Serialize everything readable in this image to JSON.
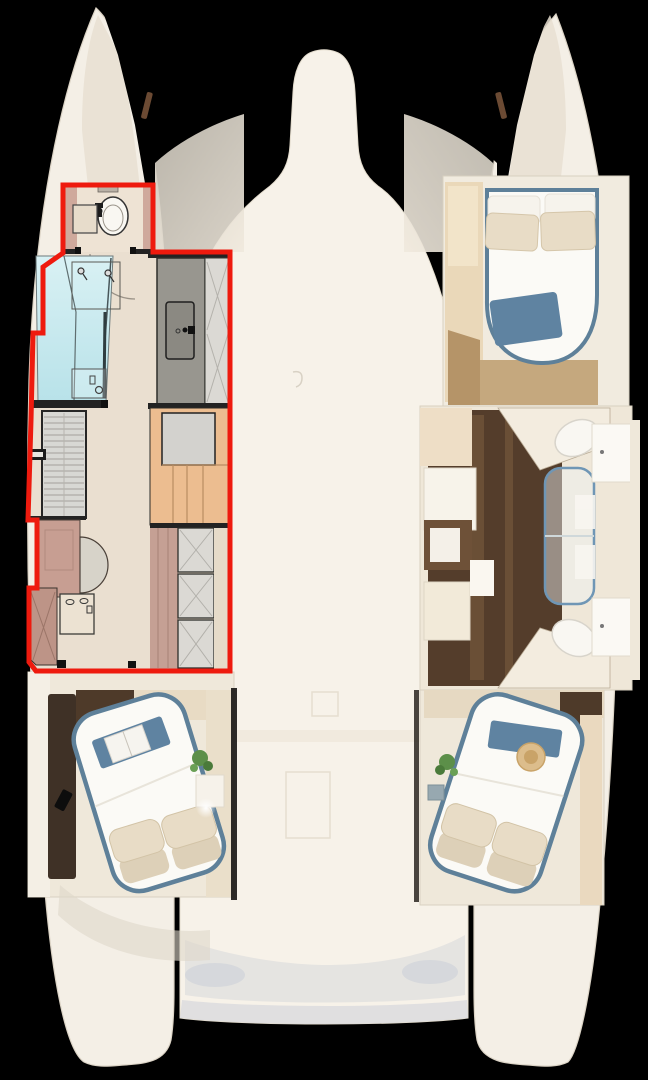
{
  "scene": {
    "kind": "catamaran-deck-floorplan-top-view",
    "background": "#000000"
  },
  "highlight": {
    "points": "63,185 153,185 153,252 230,252 230,671 36,671 29,662 29,588 37,588 37,520 28,520 31,420 33,333 43,333 43,267 63,253",
    "color": "#ee1a0e",
    "stroke_width": "5"
  },
  "colors": {
    "background": "#000000",
    "hull": "#f4efe6",
    "deck": "#f7f2e9",
    "bow_shadow": "#e7dfd1",
    "wing_shadow": "#cfc9bd",
    "plan_floor": "#eadfd0",
    "room_floor": "#eee3d4",
    "wall_pink": "#cfa99c",
    "wall_dark": "#232323",
    "shower_glass": "#c9e9ee",
    "vanity_gray": "#98968f",
    "sink_gray": "#8b8982",
    "hatch_gray": "#dbd9d4",
    "louver_gray": "#d8d8d4",
    "stairs_orange": "#ecbd90",
    "landing_gray": "#d3d2ce",
    "closet_pink": "#c5a094",
    "counter_pink": "#c79e92",
    "counter_hatch": "#bd9487",
    "basin_gray": "#d7d3c9",
    "bed_trim_blue": "#5e8099",
    "blanket_blue": "#5f83a1",
    "pillow_beige": "#e8dcc6",
    "pillow_under": "#ddd0b8",
    "mattress_white": "#fbfaf6",
    "plant_green": "#5c8f49",
    "wood_dark": "#543d2b",
    "wood_mid": "#4e3a29",
    "wood_light": "#c5a87e",
    "wardrobe_tan": "#ead8b9",
    "sideboard_dark": "#3f3126",
    "toilet_white": "#f9f7f2",
    "glass_edge_blue": "#6f96b5",
    "hat_straw": "#dcbd8c",
    "cockpit_shade": "#d4d6da",
    "deck_mark": "#e6ded0"
  }
}
